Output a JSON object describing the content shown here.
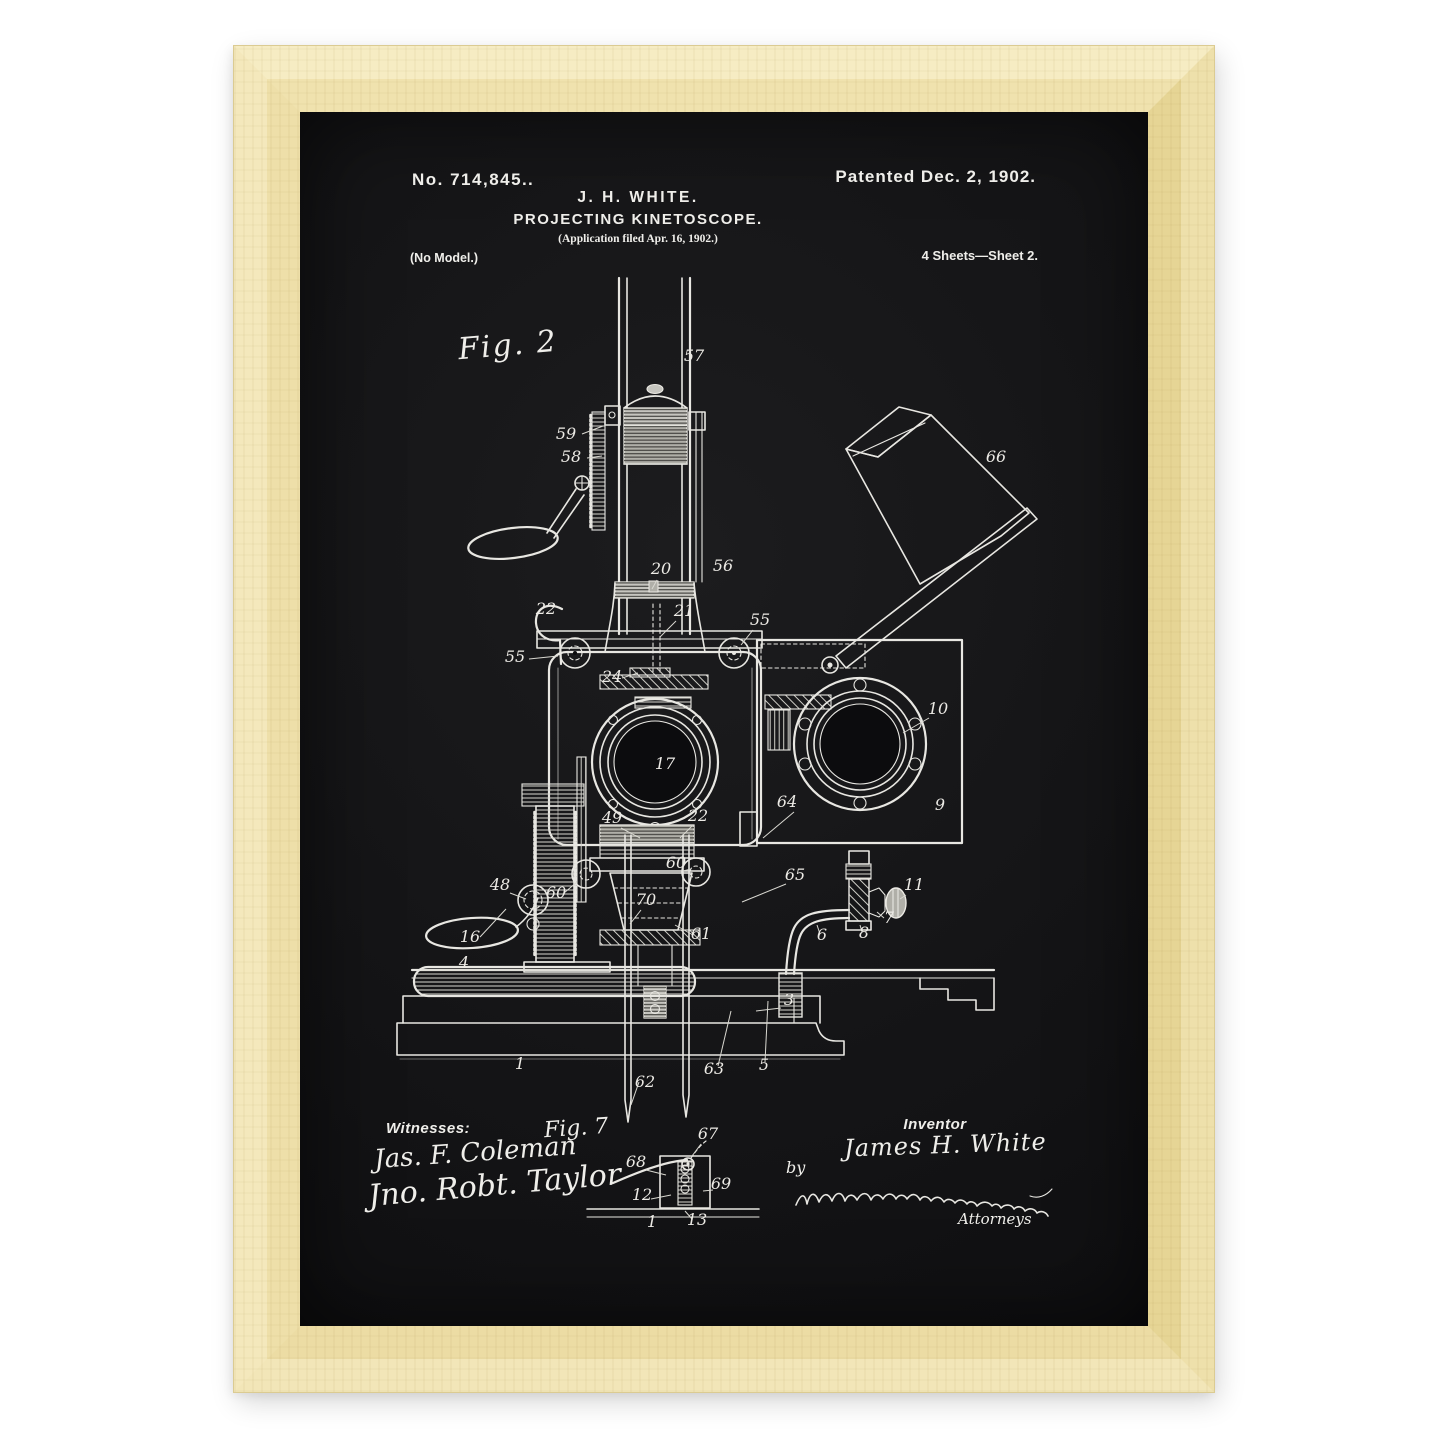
{
  "poster": {
    "patent_number": "No. 714,845.",
    "stray_period": ".",
    "patented": "Patented Dec. 2, 1902.",
    "inventor_line": "J. H. WHITE.",
    "title": "PROJECTING KINETOSCOPE.",
    "application": "(Application filed Apr. 16, 1902.)",
    "no_model": "(No Model.)",
    "sheet": "4 Sheets—Sheet 2.",
    "fig2_label": "Fig. 2",
    "fig7_label": "Fig. 7",
    "witnesses_heading": "Witnesses:",
    "witness1": "Jas. F. Coleman",
    "witness2": "Jno. Robt. Taylor",
    "inventor_heading": "Inventor",
    "inventor_name": "James H. White",
    "by_label": "by",
    "attorneys_label": "Attorneys",
    "colors": {
      "frame_wood": "#f2e4b3",
      "frame_shadow": "#e6d595",
      "poster_background": "#141416",
      "ink": "#e8e7e2"
    },
    "part_labels": [
      {
        "t": "57",
        "x": 394,
        "y": 249
      },
      {
        "t": "59",
        "x": 266,
        "y": 327,
        "l": [
          282,
          322,
          303,
          314
        ]
      },
      {
        "t": "58",
        "x": 271,
        "y": 350,
        "l": [
          287,
          346,
          302,
          344
        ]
      },
      {
        "t": "22",
        "x": 246,
        "y": 502
      },
      {
        "t": "20",
        "x": 361,
        "y": 462,
        "l": [
          357,
          468,
          352,
          477
        ]
      },
      {
        "t": "56",
        "x": 423,
        "y": 459
      },
      {
        "t": "21",
        "x": 384,
        "y": 504,
        "l": [
          376,
          509,
          360,
          525
        ]
      },
      {
        "t": "55",
        "x": 215,
        "y": 550,
        "l": [
          229,
          547,
          258,
          544
        ]
      },
      {
        "t": "55",
        "x": 460,
        "y": 513,
        "l": [
          453,
          518,
          441,
          533
        ]
      },
      {
        "t": "66",
        "x": 696,
        "y": 350
      },
      {
        "t": "24",
        "x": 312,
        "y": 570,
        "l": [
          322,
          566,
          338,
          561
        ]
      },
      {
        "t": "17",
        "x": 365,
        "y": 657
      },
      {
        "t": "10",
        "x": 638,
        "y": 602,
        "l": [
          629,
          606,
          603,
          621
        ]
      },
      {
        "t": "9",
        "x": 640,
        "y": 698
      },
      {
        "t": "64",
        "x": 487,
        "y": 695,
        "l": [
          494,
          700,
          463,
          726
        ]
      },
      {
        "t": "49",
        "x": 312,
        "y": 711,
        "l": [
          321,
          716,
          340,
          726
        ]
      },
      {
        "t": "22",
        "x": 398,
        "y": 709,
        "l": [
          392,
          714,
          380,
          726
        ]
      },
      {
        "t": "48",
        "x": 200,
        "y": 778,
        "l": [
          210,
          781,
          226,
          787
        ]
      },
      {
        "t": "60",
        "x": 256,
        "y": 786,
        "l": [
          264,
          781,
          277,
          770
        ]
      },
      {
        "t": "60",
        "x": 376,
        "y": 756,
        "l": [
          383,
          759,
          391,
          757
        ]
      },
      {
        "t": "16",
        "x": 170,
        "y": 830,
        "l": [
          180,
          825,
          206,
          797
        ]
      },
      {
        "t": "70",
        "x": 346,
        "y": 793,
        "l": [
          341,
          798,
          330,
          812
        ]
      },
      {
        "t": "61",
        "x": 401,
        "y": 827,
        "l": [
          393,
          823,
          375,
          813
        ]
      },
      {
        "t": "65",
        "x": 495,
        "y": 768,
        "l": [
          486,
          772,
          442,
          790
        ]
      },
      {
        "t": "11",
        "x": 614,
        "y": 778,
        "l": [
          606,
          783,
          600,
          787
        ]
      },
      {
        "t": "7",
        "x": 589,
        "y": 811,
        "l": [
          584,
          806,
          577,
          800
        ]
      },
      {
        "t": "8",
        "x": 564,
        "y": 826,
        "l": [
          562,
          820,
          560,
          813
        ]
      },
      {
        "t": "6",
        "x": 522,
        "y": 828,
        "l": [
          520,
          822,
          517,
          813
        ]
      },
      {
        "t": "4",
        "x": 164,
        "y": 856
      },
      {
        "t": "3",
        "x": 489,
        "y": 893,
        "l": [
          481,
          896,
          456,
          899
        ]
      },
      {
        "t": "1",
        "x": 220,
        "y": 957
      },
      {
        "t": "62",
        "x": 345,
        "y": 975,
        "l": [
          339,
          970,
          331,
          993
        ]
      },
      {
        "t": "63",
        "x": 414,
        "y": 962,
        "l": [
          418,
          954,
          431,
          899
        ]
      },
      {
        "t": "5",
        "x": 464,
        "y": 958,
        "l": [
          465,
          950,
          468,
          889
        ]
      },
      {
        "t": "67",
        "x": 408,
        "y": 1027,
        "l": [
          401,
          1032,
          392,
          1044
        ]
      },
      {
        "t": "68",
        "x": 336,
        "y": 1055,
        "l": [
          346,
          1058,
          366,
          1063
        ]
      },
      {
        "t": "69",
        "x": 421,
        "y": 1077,
        "l": [
          413,
          1078,
          403,
          1079
        ]
      },
      {
        "t": "12",
        "x": 342,
        "y": 1088,
        "l": [
          351,
          1087,
          371,
          1083
        ]
      },
      {
        "t": "1",
        "x": 352,
        "y": 1115
      },
      {
        "t": "13",
        "x": 397,
        "y": 1113,
        "l": [
          392,
          1107,
          385,
          1099
        ]
      }
    ]
  }
}
